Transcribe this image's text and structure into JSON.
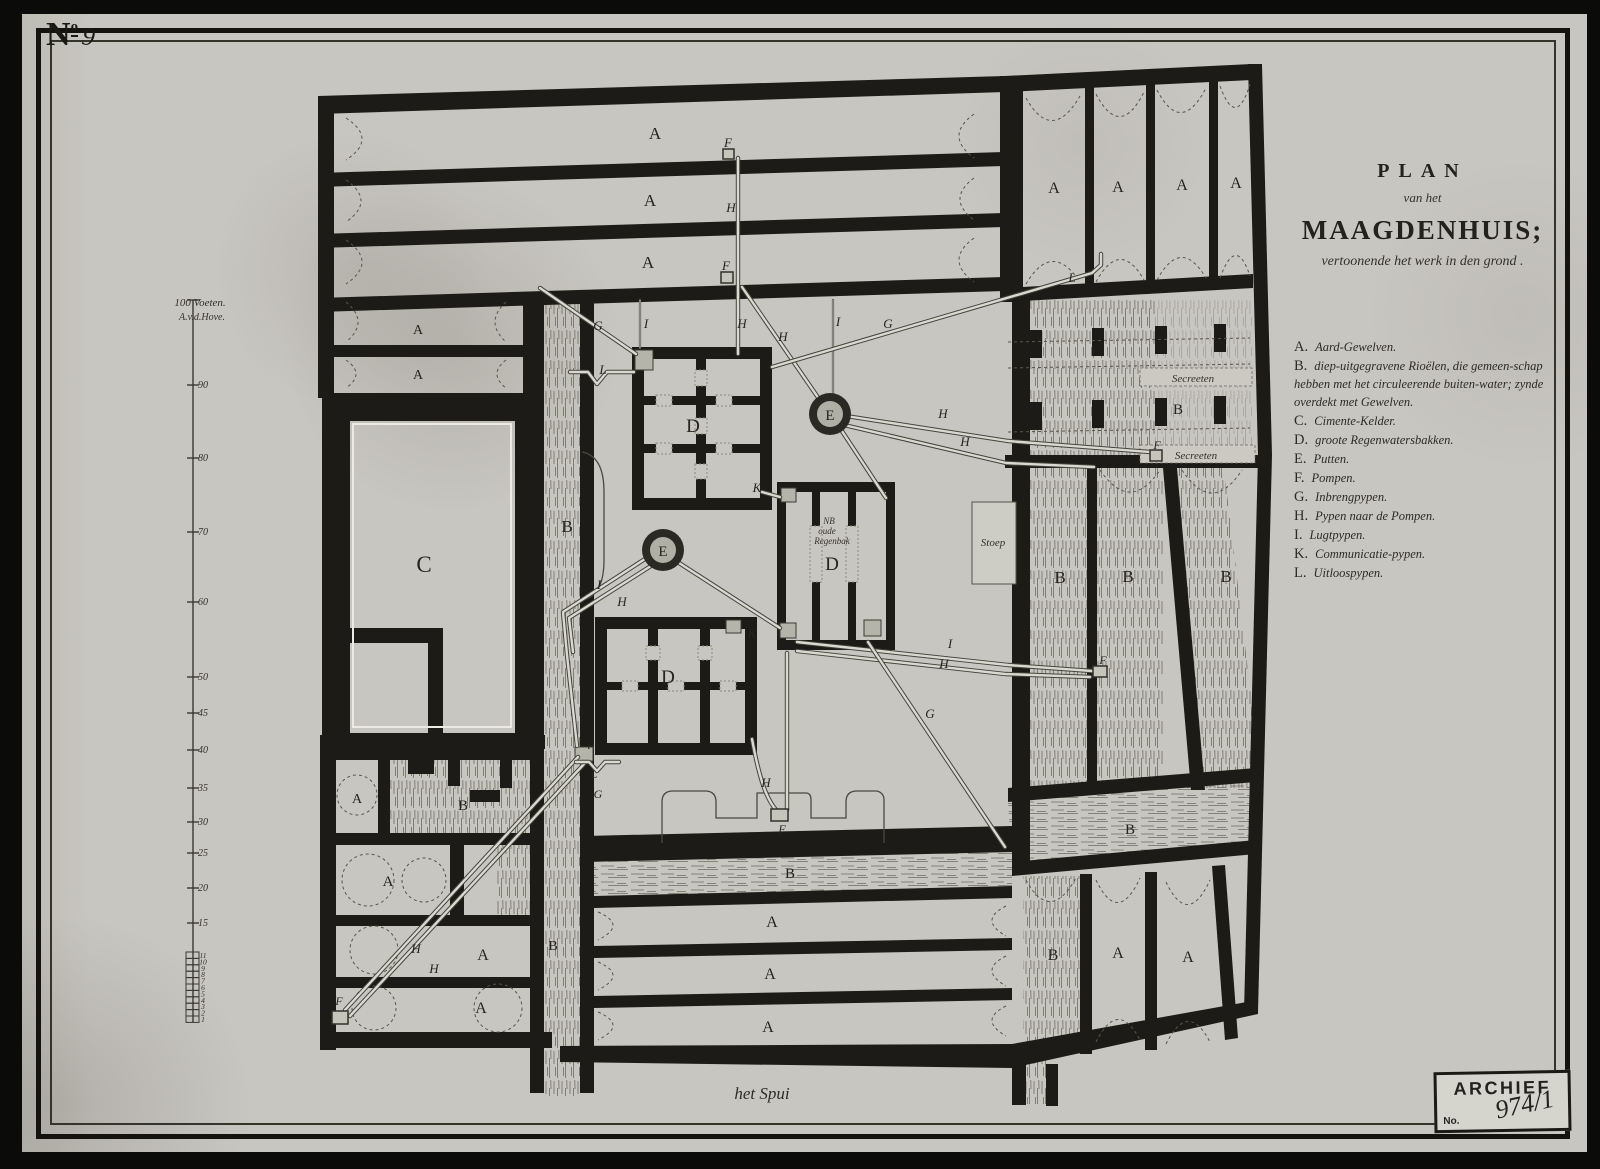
{
  "corner": {
    "n": "N",
    "sup": "o",
    "number": "9"
  },
  "title": {
    "plan": "PLAN",
    "van_het": "van het",
    "name": "MAAGDENHUIS;",
    "subtitle": "vertoonende het werk in den grond ."
  },
  "legend": {
    "items": [
      {
        "key": "A.",
        "text": "Aard-Gewelven."
      },
      {
        "key": "B.",
        "text": "diep-uitgegravene Rioëlen, die gemeen-schap hebben met het circuleerende buiten-water; zynde overdekt met Gewelven."
      },
      {
        "key": "C.",
        "text": "Cimente-Kelder."
      },
      {
        "key": "D.",
        "text": "groote Regenwatersbakken."
      },
      {
        "key": "E.",
        "text": "Putten."
      },
      {
        "key": "F.",
        "text": "Pompen."
      },
      {
        "key": "G.",
        "text": "Inbrengpypen."
      },
      {
        "key": "H.",
        "text": "Pypen naar de Pompen."
      },
      {
        "key": "I.",
        "text": "Lugtpypen."
      },
      {
        "key": "K.",
        "text": "Communicatie-pypen."
      },
      {
        "key": "L.",
        "text": "Uitloospypen."
      }
    ]
  },
  "scale_bar": {
    "label1": "100 Voeten.",
    "label2": "A.v.d.Hove.",
    "ticks": [
      {
        "t": "90",
        "y": 385
      },
      {
        "t": "80",
        "y": 458
      },
      {
        "t": "70",
        "y": 532
      },
      {
        "t": "60",
        "y": 602
      },
      {
        "t": "50",
        "y": 677
      },
      {
        "t": "45",
        "y": 713
      },
      {
        "t": "40",
        "y": 750
      },
      {
        "t": "35",
        "y": 788
      },
      {
        "t": "30",
        "y": 822
      },
      {
        "t": "25",
        "y": 853
      },
      {
        "t": "20",
        "y": 888
      },
      {
        "t": "15",
        "y": 923
      }
    ],
    "ladder": [
      "11",
      "10",
      "9",
      "8",
      "7",
      "6",
      "5",
      "4",
      "3",
      "2",
      "1"
    ]
  },
  "street_label": "het Spui",
  "stamp": {
    "title": "ARCHIEF",
    "no_label": "No.",
    "number": "974/1"
  },
  "colors": {
    "paper": "#c8c6c0",
    "ink": "#1c1b17",
    "pipe_inner": "#dad9d1",
    "pipe_outer": "#45443b"
  },
  "plan": {
    "letters": [
      {
        "t": "A",
        "x": 655,
        "y": 139,
        "s": 17,
        "c": "r"
      },
      {
        "t": "A",
        "x": 650,
        "y": 206,
        "s": 17,
        "c": "r"
      },
      {
        "t": "A",
        "x": 648,
        "y": 268,
        "s": 17,
        "c": "r"
      },
      {
        "t": "A",
        "x": 418,
        "y": 334,
        "s": 14,
        "c": "r"
      },
      {
        "t": "A",
        "x": 418,
        "y": 379,
        "s": 14,
        "c": "r"
      },
      {
        "t": "A",
        "x": 1054,
        "y": 193,
        "s": 16,
        "c": "r"
      },
      {
        "t": "A",
        "x": 1118,
        "y": 192,
        "s": 16,
        "c": "r"
      },
      {
        "t": "A",
        "x": 1182,
        "y": 190,
        "s": 16,
        "c": "r"
      },
      {
        "t": "A",
        "x": 1236,
        "y": 188,
        "s": 16,
        "c": "r"
      },
      {
        "t": "F",
        "x": 728,
        "y": 147,
        "s": 13,
        "c": "i"
      },
      {
        "t": "H",
        "x": 731,
        "y": 212,
        "s": 13,
        "c": "i"
      },
      {
        "t": "F",
        "x": 726,
        "y": 270,
        "s": 13,
        "c": "i"
      },
      {
        "t": "H",
        "x": 742,
        "y": 328,
        "s": 13,
        "c": "i"
      },
      {
        "t": "H",
        "x": 783,
        "y": 341,
        "s": 13,
        "c": "i"
      },
      {
        "t": "G",
        "x": 598,
        "y": 330,
        "s": 13,
        "c": "i"
      },
      {
        "t": "I",
        "x": 646,
        "y": 328,
        "s": 13,
        "c": "i"
      },
      {
        "t": "L",
        "x": 603,
        "y": 374,
        "s": 13,
        "c": "i"
      },
      {
        "t": "D",
        "x": 693,
        "y": 432,
        "s": 19,
        "c": "r"
      },
      {
        "t": "K",
        "x": 757,
        "y": 492,
        "s": 13,
        "c": "i"
      },
      {
        "t": "I",
        "x": 838,
        "y": 326,
        "s": 13,
        "c": "i"
      },
      {
        "t": "G",
        "x": 888,
        "y": 328,
        "s": 13,
        "c": "i"
      },
      {
        "t": "L",
        "x": 1072,
        "y": 282,
        "s": 13,
        "c": "i"
      },
      {
        "t": "E",
        "x": 830,
        "y": 420,
        "s": 15,
        "c": "r"
      },
      {
        "t": "H",
        "x": 943,
        "y": 418,
        "s": 13,
        "c": "i"
      },
      {
        "t": "H",
        "x": 965,
        "y": 446,
        "s": 13,
        "c": "i"
      },
      {
        "t": "B",
        "x": 567,
        "y": 532,
        "s": 17,
        "c": "r"
      },
      {
        "t": "C",
        "x": 424,
        "y": 572,
        "s": 23,
        "c": "r"
      },
      {
        "t": "E",
        "x": 663,
        "y": 556,
        "s": 15,
        "c": "r"
      },
      {
        "t": "I",
        "x": 599,
        "y": 589,
        "s": 13,
        "c": "i"
      },
      {
        "t": "H",
        "x": 622,
        "y": 606,
        "s": 13,
        "c": "i"
      },
      {
        "t": "NB",
        "x": 829,
        "y": 524,
        "s": 9,
        "c": "h"
      },
      {
        "t": "oude",
        "x": 827,
        "y": 534,
        "s": 9,
        "c": "h"
      },
      {
        "t": "Regenbak",
        "x": 832,
        "y": 544,
        "s": 9,
        "c": "h"
      },
      {
        "t": "D",
        "x": 832,
        "y": 570,
        "s": 19,
        "c": "r"
      },
      {
        "t": "Stoep",
        "x": 993,
        "y": 546,
        "s": 11,
        "c": "h"
      },
      {
        "t": "Secreeten",
        "x": 1193,
        "y": 382,
        "s": 11,
        "c": "h"
      },
      {
        "t": "B",
        "x": 1178,
        "y": 414,
        "s": 15,
        "c": "r"
      },
      {
        "t": "Secreeten",
        "x": 1196,
        "y": 459,
        "s": 11,
        "c": "h"
      },
      {
        "t": "F",
        "x": 1157,
        "y": 449,
        "s": 12,
        "c": "i"
      },
      {
        "t": "B",
        "x": 1060,
        "y": 583,
        "s": 17,
        "c": "r"
      },
      {
        "t": "B",
        "x": 1128,
        "y": 582,
        "s": 17,
        "c": "r"
      },
      {
        "t": "B",
        "x": 1226,
        "y": 582,
        "s": 17,
        "c": "r"
      },
      {
        "t": "F",
        "x": 1103,
        "y": 664,
        "s": 12,
        "c": "i"
      },
      {
        "t": "D",
        "x": 668,
        "y": 683,
        "s": 19,
        "c": "r"
      },
      {
        "t": "K",
        "x": 752,
        "y": 638,
        "s": 13,
        "c": "i"
      },
      {
        "t": "i",
        "x": 589,
        "y": 749,
        "s": 12,
        "c": "i"
      },
      {
        "t": "L",
        "x": 594,
        "y": 778,
        "s": 12,
        "c": "i"
      },
      {
        "t": "G",
        "x": 598,
        "y": 798,
        "s": 12,
        "c": "i"
      },
      {
        "t": "I",
        "x": 950,
        "y": 648,
        "s": 13,
        "c": "i"
      },
      {
        "t": "H",
        "x": 944,
        "y": 668,
        "s": 13,
        "c": "i"
      },
      {
        "t": "G",
        "x": 930,
        "y": 718,
        "s": 13,
        "c": "i"
      },
      {
        "t": "H",
        "x": 766,
        "y": 787,
        "s": 13,
        "c": "i"
      },
      {
        "t": "F",
        "x": 782,
        "y": 833,
        "s": 12,
        "c": "i"
      },
      {
        "t": "B",
        "x": 790,
        "y": 878,
        "s": 15,
        "c": "r"
      },
      {
        "t": "A",
        "x": 772,
        "y": 927,
        "s": 16,
        "c": "r"
      },
      {
        "t": "A",
        "x": 770,
        "y": 979,
        "s": 16,
        "c": "r"
      },
      {
        "t": "A",
        "x": 768,
        "y": 1032,
        "s": 16,
        "c": "r"
      },
      {
        "t": "A",
        "x": 357,
        "y": 803,
        "s": 14,
        "c": "r"
      },
      {
        "t": "B",
        "x": 463,
        "y": 810,
        "s": 15,
        "c": "r"
      },
      {
        "t": "A",
        "x": 388,
        "y": 886,
        "s": 15,
        "c": "r"
      },
      {
        "t": "A",
        "x": 483,
        "y": 960,
        "s": 16,
        "c": "r"
      },
      {
        "t": "A",
        "x": 481,
        "y": 1013,
        "s": 16,
        "c": "r"
      },
      {
        "t": "H",
        "x": 416,
        "y": 953,
        "s": 13,
        "c": "i"
      },
      {
        "t": "H",
        "x": 434,
        "y": 973,
        "s": 13,
        "c": "i"
      },
      {
        "t": "F",
        "x": 339,
        "y": 1005,
        "s": 12,
        "c": "i"
      },
      {
        "t": "B",
        "x": 553,
        "y": 950,
        "s": 14,
        "c": "r"
      },
      {
        "t": "B",
        "x": 1053,
        "y": 960,
        "s": 16,
        "c": "r"
      },
      {
        "t": "A",
        "x": 1118,
        "y": 958,
        "s": 16,
        "c": "r"
      },
      {
        "t": "A",
        "x": 1188,
        "y": 962,
        "s": 16,
        "c": "r"
      },
      {
        "t": "B",
        "x": 1130,
        "y": 834,
        "s": 15,
        "c": "r"
      }
    ],
    "pipes": [
      {
        "d": "M738,158 L738,354"
      },
      {
        "d": "M742,287 L828,412"
      },
      {
        "d": "M832,416 L886,498"
      },
      {
        "d": "M833,300 L833,396",
        "thin": true
      },
      {
        "d": "M1101,254 L1101,265 L1092,273 L772,367"
      },
      {
        "d": "M540,288 L636,354"
      },
      {
        "d": "M640,300 L640,348",
        "thin": true
      },
      {
        "d": "M570,372 L588,372 L597,384 L607,372 L634,372"
      },
      {
        "d": "M846,416 L1008,441 L1150,452"
      },
      {
        "d": "M844,425 L1006,463 L1094,467"
      },
      {
        "d": "M648,557 L563,612 L567,655 L577,746"
      },
      {
        "d": "M654,564 L569,618 L573,652"
      },
      {
        "d": "M676,561 L780,628"
      },
      {
        "d": "M762,492 L780,497"
      },
      {
        "d": "M797,642 L1008,665 L1092,671"
      },
      {
        "d": "M797,651 L1005,674 L1090,677"
      },
      {
        "d": "M868,642 L1005,847"
      },
      {
        "d": "M578,757 L345,1010"
      },
      {
        "d": "M584,764 L350,1016"
      },
      {
        "d": "M787,653 L787,810"
      },
      {
        "d": "M752,739 C760,782 767,800 777,811"
      },
      {
        "d": "M576,762 L589,762 L597,771 L605,762 L619,762"
      }
    ]
  }
}
